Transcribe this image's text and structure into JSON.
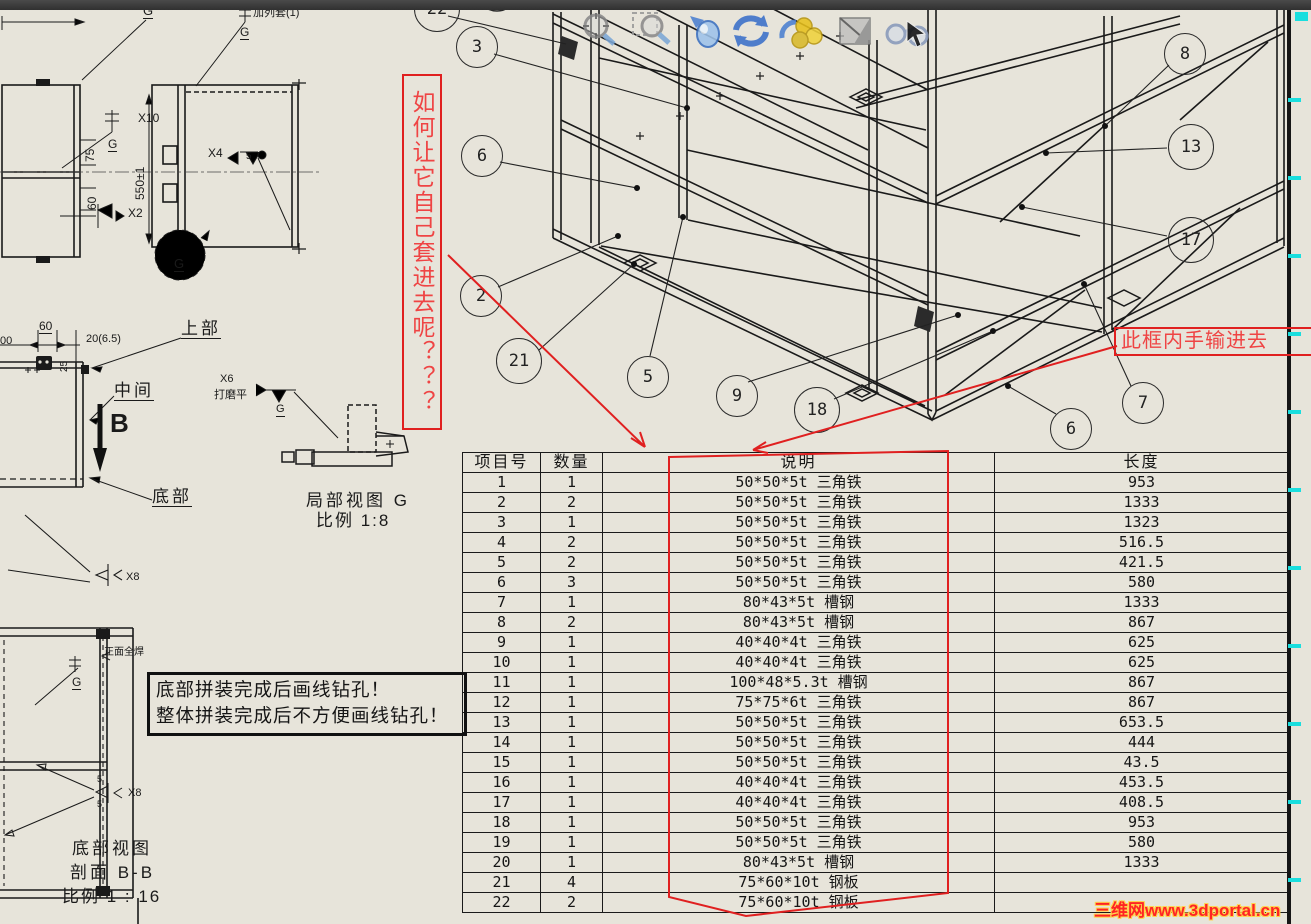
{
  "annotations": {
    "vertical_question": "如何让它自己套进去呢？？？",
    "manual_input_note": "此框内手输进去",
    "assembly_note_line1": "底部拼装完成后画线钻孔！",
    "assembly_note_line2": "整体拼装完成后不方便画线钻孔！",
    "watermark": "三维网www.3dportal.cn"
  },
  "balloons": [
    "22",
    "3",
    "6",
    "2",
    "21",
    "5",
    "9",
    "18",
    "8",
    "13",
    "17",
    "7",
    "6"
  ],
  "views": {
    "upper_label": "上部",
    "middle_label": "中间",
    "bottom_label": "底部",
    "section_arrow_label": "B",
    "detail_view_label": "局部视图 G",
    "detail_view_scale": "比例 1:8",
    "bottom_view_label": "底部视图",
    "section_label": "剖面 B-B",
    "section_scale": "比例 1 : 16"
  },
  "weld_notes": {
    "x10": "X10",
    "x2": "X2",
    "x4": "X4",
    "x6": "X6",
    "x8": "X8",
    "x8b": "X8",
    "g1": "G",
    "g2": "G",
    "g3": "G",
    "g4": "G",
    "g5": "G",
    "g6": "G",
    "grind_note": "打磨平",
    "top_note": "加列套(1)",
    "front_note": "正面全焊",
    "five_a": "5",
    "five_b": "5",
    "five_c": "5"
  },
  "dimensions": {
    "d75": "75",
    "d60a": "60",
    "d60b": "60",
    "d550": "550±1",
    "d20": "20(6.5)",
    "d25": "25",
    "d00": "00"
  },
  "table": {
    "headers": [
      "项目号",
      "数量",
      "说明",
      "长度"
    ],
    "rows": [
      [
        "1",
        "1",
        "50*50*5t  三角铁",
        "953"
      ],
      [
        "2",
        "2",
        "50*50*5t  三角铁",
        "1333"
      ],
      [
        "3",
        "1",
        "50*50*5t  三角铁",
        "1323"
      ],
      [
        "4",
        "2",
        "50*50*5t  三角铁",
        "516.5"
      ],
      [
        "5",
        "2",
        "50*50*5t  三角铁",
        "421.5"
      ],
      [
        "6",
        "3",
        "50*50*5t  三角铁",
        "580"
      ],
      [
        "7",
        "1",
        "80*43*5t  槽钢",
        "1333"
      ],
      [
        "8",
        "2",
        "80*43*5t  槽钢",
        "867"
      ],
      [
        "9",
        "1",
        "40*40*4t  三角铁",
        "625"
      ],
      [
        "10",
        "1",
        "40*40*4t  三角铁",
        "625"
      ],
      [
        "11",
        "1",
        "100*48*5.3t 槽钢",
        "867"
      ],
      [
        "12",
        "1",
        "75*75*6t  三角铁",
        "867"
      ],
      [
        "13",
        "1",
        "50*50*5t  三角铁",
        "653.5"
      ],
      [
        "14",
        "1",
        "50*50*5t  三角铁",
        "444"
      ],
      [
        "15",
        "1",
        "50*50*5t  三角铁",
        "43.5"
      ],
      [
        "16",
        "1",
        "40*40*4t  三角铁",
        "453.5"
      ],
      [
        "17",
        "1",
        "40*40*4t  三角铁",
        "408.5"
      ],
      [
        "18",
        "1",
        "50*50*5t  三角铁",
        "953"
      ],
      [
        "19",
        "1",
        "50*50*5t  三角铁",
        "580"
      ],
      [
        "20",
        "1",
        "80*43*5t  槽钢",
        "1333"
      ],
      [
        "21",
        "4",
        "75*60*10t  钢板",
        ""
      ],
      [
        "22",
        "2",
        "75*60*10t  钢板",
        ""
      ]
    ]
  },
  "toolbar": {
    "icons": [
      "zoom-to-fit",
      "zoom-to-area",
      "previous-view",
      "rotate-view",
      "apply-appearance",
      "section-view",
      "view-orientation"
    ]
  },
  "colors": {
    "sheet": "#e7e4da",
    "annotation_red": "#e02020",
    "cyan_tick": "#19dede",
    "watermark_red": "#ff2424",
    "watermark_glow": "#ffd34d"
  }
}
